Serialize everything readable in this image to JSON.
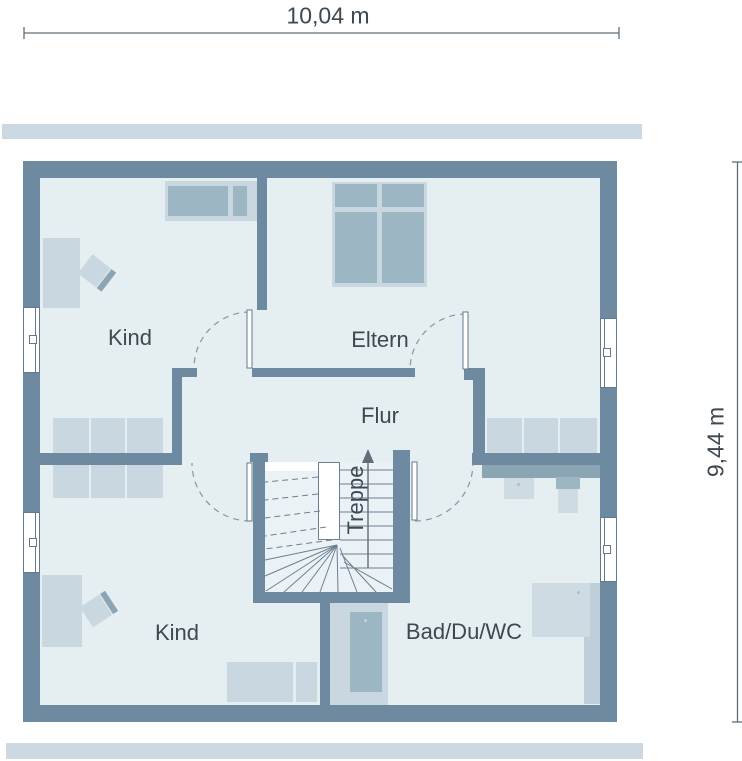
{
  "plan_type": "floor-plan",
  "dimensions": {
    "width": "10,04 m",
    "height": "9,44 m"
  },
  "rooms": [
    {
      "name": "Kind"
    },
    {
      "name": "Eltern"
    },
    {
      "name": "Flur"
    },
    {
      "name": "Treppe"
    },
    {
      "name": "Kind"
    },
    {
      "name": "Bad/Du/WC"
    }
  ],
  "colors": {
    "wall": "#6d8aa1",
    "floor": "#e5eef1",
    "stair_floor": "#eaf2f5",
    "furniture_light": "#c9d7e0",
    "furniture_medium": "#9db6c4",
    "fixture_dark": "#8ba5b5",
    "fixture_light": "#cfdbe3",
    "fixture_mid": "#bfcfda",
    "band": "#ccd9e3",
    "label_text": "#3d4852",
    "dimension": "#5f6e79",
    "door_line": "#64798c",
    "arc_line": "#8496a5",
    "stair_line": "#6b8093"
  }
}
